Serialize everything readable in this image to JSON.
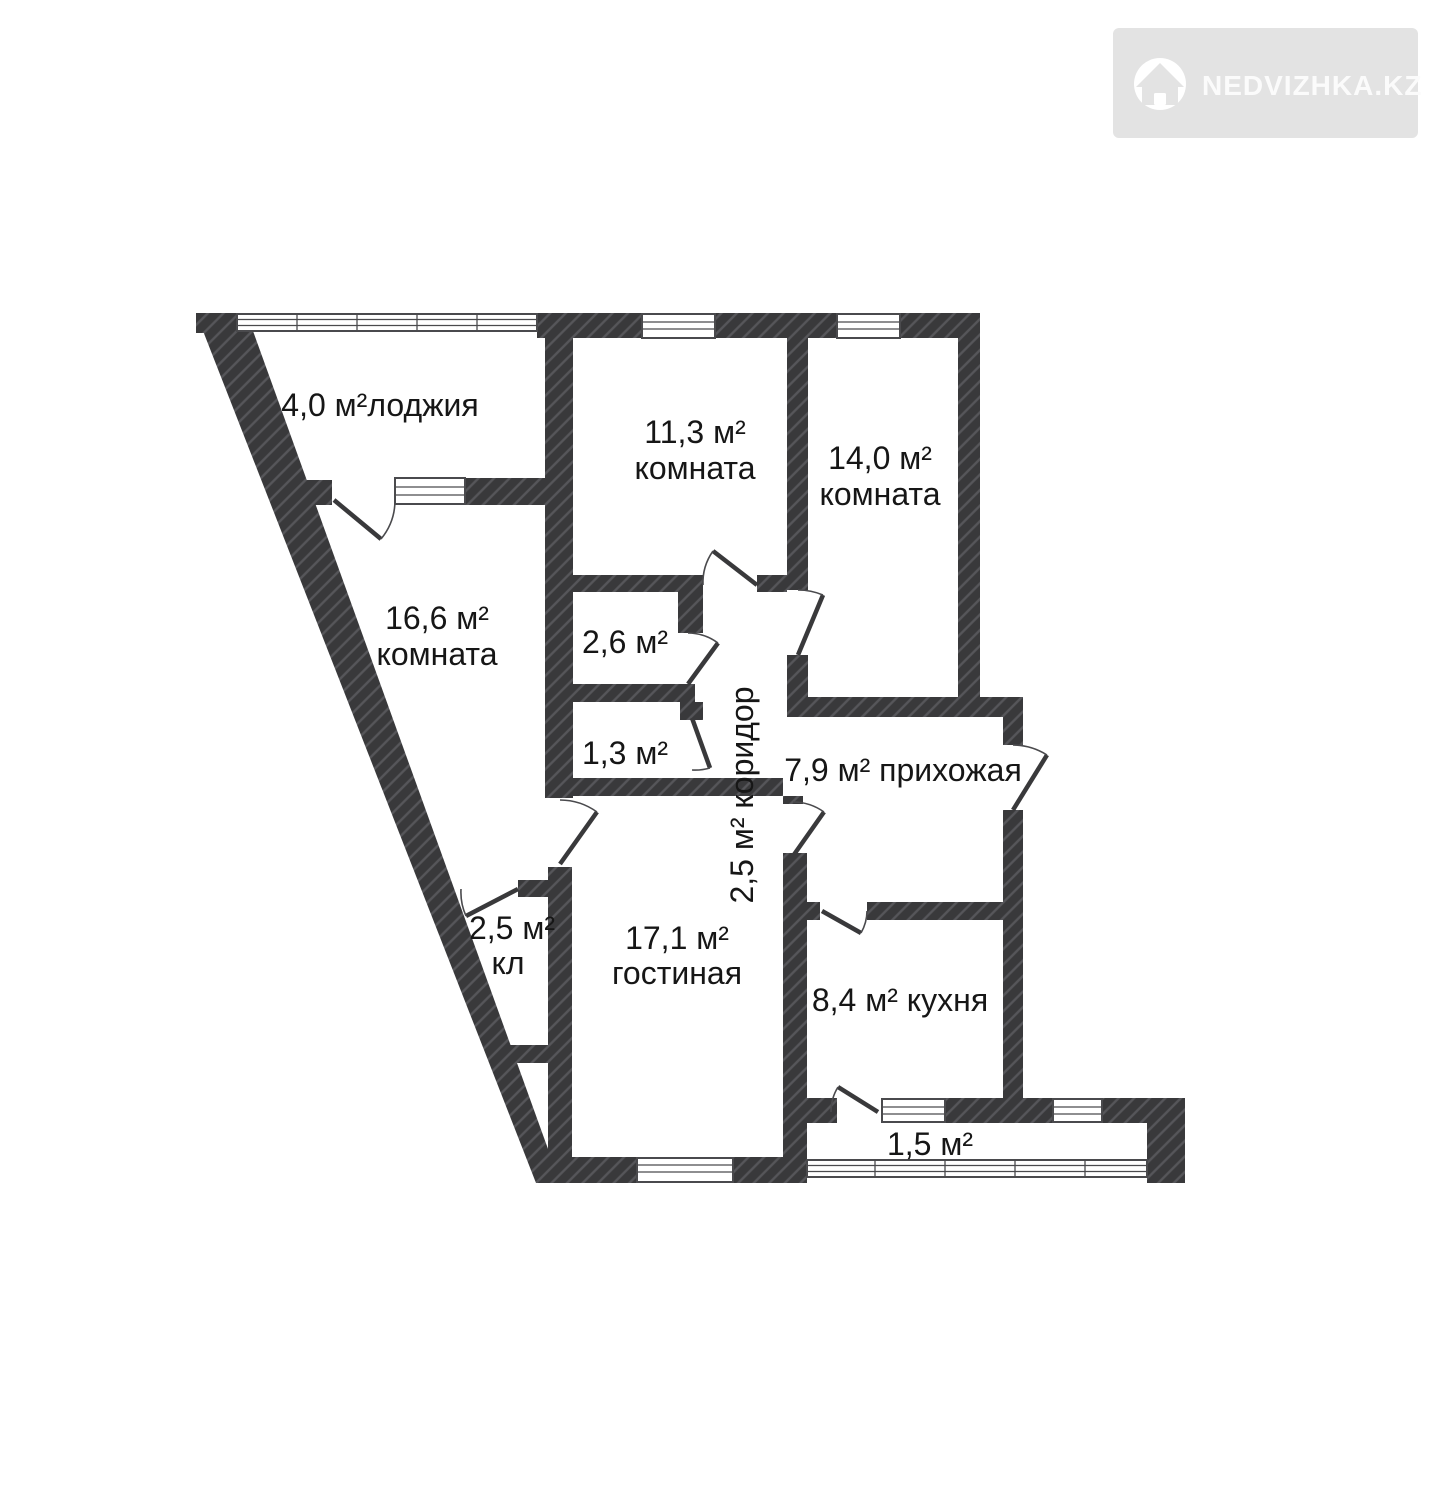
{
  "watermark": {
    "brand": "NEDVIZHKA.KZ"
  },
  "colors": {
    "wall": "#39393b",
    "hatch": "#56565a",
    "line": "#4a4a4d",
    "text": "#161616",
    "wm_bg": "#e3e3e3",
    "wm_fg": "#fbfbfb"
  },
  "plan": {
    "rooms": [
      {
        "id": "loggia",
        "line1": "4,0 м²лоджия"
      },
      {
        "id": "bedroom-1",
        "line1": "11,3 м²",
        "line2": "комната"
      },
      {
        "id": "bedroom-2",
        "line1": "14,0 м²",
        "line2": "комната"
      },
      {
        "id": "bedroom-3",
        "line1": "16,6 м²",
        "line2": "комната"
      },
      {
        "id": "bathroom",
        "line1": "2,6 м²"
      },
      {
        "id": "wc",
        "line1": "1,3 м²"
      },
      {
        "id": "corridor",
        "line1": "2,5 м² коридор"
      },
      {
        "id": "hallway",
        "line1": "7,9 м² прихожая"
      },
      {
        "id": "closet",
        "line1": "2,5 м²",
        "line2": "кл"
      },
      {
        "id": "living-room",
        "line1": "17,1 м²",
        "line2": "гостиная"
      },
      {
        "id": "kitchen",
        "line1": "8,4 м² кухня"
      },
      {
        "id": "balcony",
        "line1": "1,5 м²"
      }
    ]
  }
}
